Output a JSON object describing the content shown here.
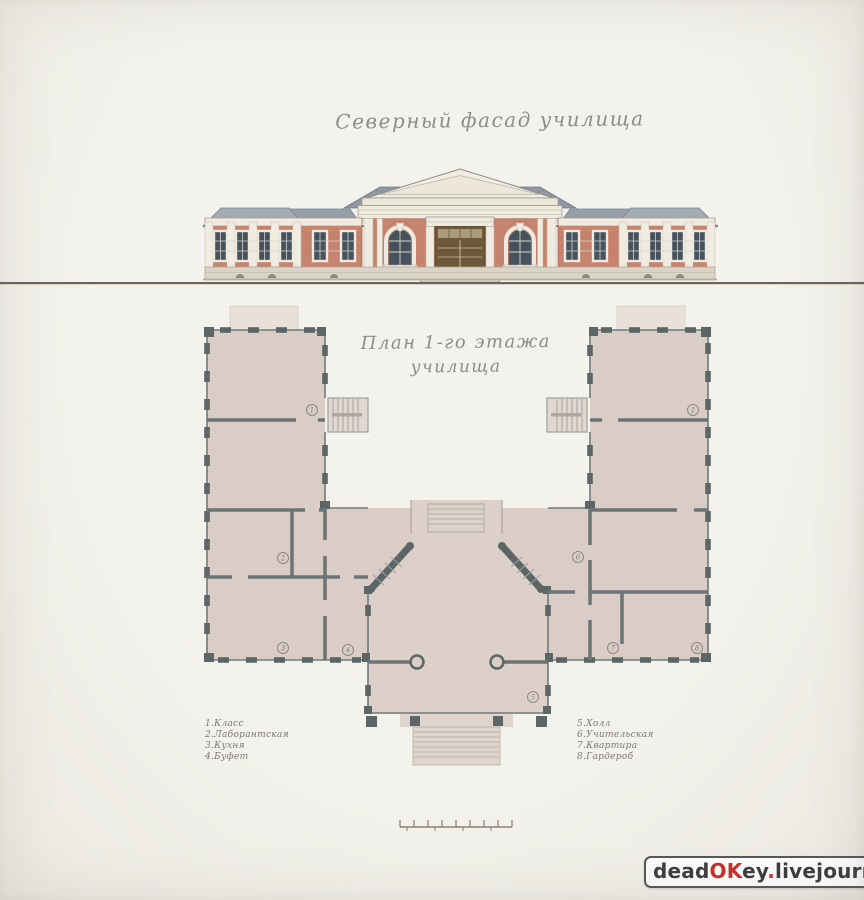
{
  "facade": {
    "title": "Северный фасад училища"
  },
  "plan": {
    "title_line1": "План 1-го этажа",
    "title_line2": "училища",
    "legend_left": [
      "1.Класс",
      "2.Лаборантская",
      "3.Кухня",
      "4.Буфет"
    ],
    "legend_right": [
      "5.Холл",
      "6.Учительская",
      "7.Квартира",
      "8.Гардероб"
    ],
    "room_numbers": [
      "1",
      "1",
      "2",
      "3",
      "4",
      "5",
      "6",
      "7",
      "8"
    ]
  },
  "watermark": {
    "dead": "dead",
    "ok": "OK",
    "ey": "ey",
    "dot1": ".",
    "livejournal": "livejournal",
    "dot2": ".",
    "com": "com"
  },
  "colors": {
    "paper": "#f2f1eb",
    "brick": "#c6836e",
    "trim_white": "#f0ebe0",
    "roof_gray": "#97a0a9",
    "window_glass": "#46525e",
    "door_wood": "#6e583a",
    "ground_line": "#6f6450",
    "plan_wall": "#5c6667",
    "plan_floor": "#dacdc5",
    "watermark_red": "#c4322e"
  }
}
